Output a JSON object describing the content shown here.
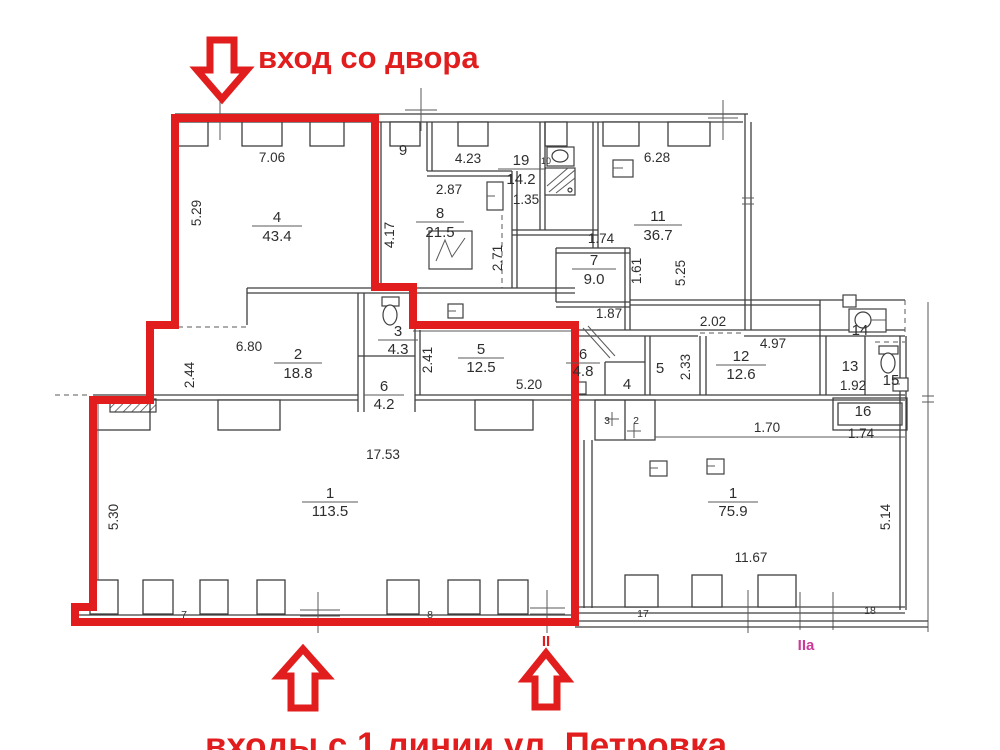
{
  "colors": {
    "highlight_red": "#e11d1d",
    "marker_iia_pink": "#cc3a99",
    "plan_line": "#3f3f3f",
    "background": "#ffffff"
  },
  "annotations": {
    "top_entrance": "вход со двора",
    "bottom_entrance": "входы с 1 линии ул. Петровка",
    "marker_ii": "II",
    "marker_iia": "IIa"
  },
  "rooms": {
    "room4": {
      "num": "4",
      "area": "43.4"
    },
    "room8": {
      "num": "8",
      "area": "21.5"
    },
    "room19": {
      "num": "19",
      "area": "14.2"
    },
    "room11": {
      "num": "11",
      "area": "36.7"
    },
    "room7": {
      "num": "7",
      "area": "9.0"
    },
    "room2": {
      "num": "2",
      "area": "18.8"
    },
    "room3": {
      "num": "3",
      "area": "4.3"
    },
    "room6a": {
      "num": "6",
      "area": "4.2"
    },
    "room5": {
      "num": "5",
      "area": "12.5"
    },
    "room6b": {
      "num": "6",
      "area": "4.8"
    },
    "room12": {
      "num": "12",
      "area": "12.6"
    },
    "room1a": {
      "num": "1",
      "area": "113.5"
    },
    "room1b": {
      "num": "1",
      "area": "75.9"
    }
  },
  "labels": {
    "w706": "7.06",
    "r9": "9",
    "w423": "4.23",
    "d287": "2.87",
    "d135": "1.35",
    "w628": "6.28",
    "v529": "5.29",
    "v417": "4.17",
    "v271": "2.71",
    "d174a": "1.74",
    "v161": "1.61",
    "v525": "5.25",
    "d187": "1.87",
    "d202": "2.02",
    "d680": "6.80",
    "v244": "2.44",
    "v241": "2.41",
    "d520": "5.20",
    "r4s": "4",
    "r5s": "5",
    "v233": "2.33",
    "d497": "4.97",
    "r13": "13",
    "d192": "1.92",
    "r14": "14",
    "r15": "15",
    "r16": "16",
    "d174b": "1.74",
    "d170": "1.70",
    "r3s": "3",
    "r2s": "2",
    "d1753": "17.53",
    "v530": "5.30",
    "d1167": "11.67",
    "v514": "5.14",
    "r10": "10",
    "win7": "7",
    "win8": "8",
    "win17": "17",
    "win18": "18"
  }
}
